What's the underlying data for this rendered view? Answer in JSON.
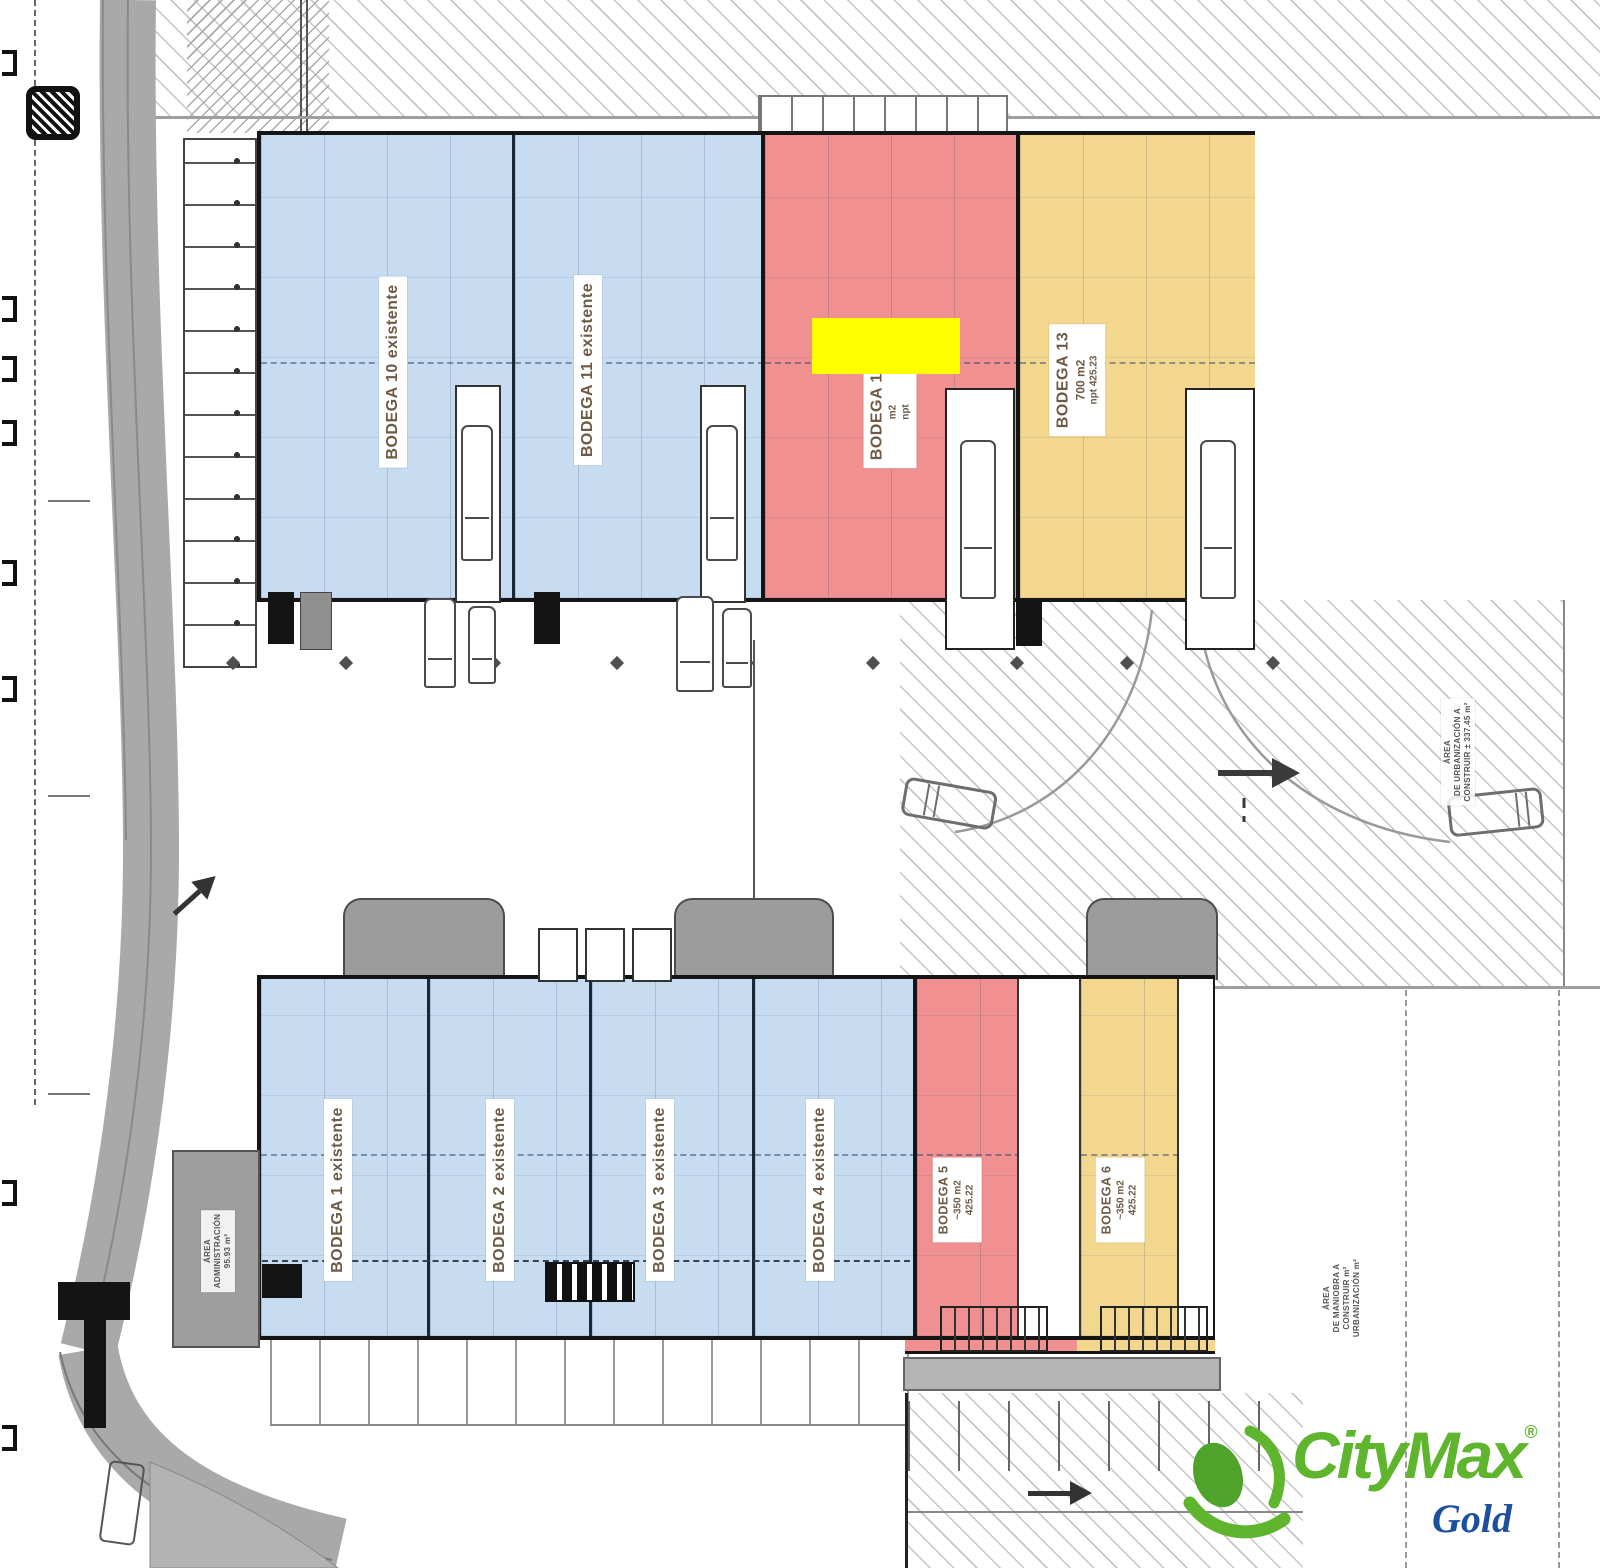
{
  "warehouses": {
    "top_row": [
      {
        "id": "bodega-10",
        "label": "BODEGA 10 existente",
        "fill": "#c7dbf1",
        "status": "existente"
      },
      {
        "id": "bodega-11",
        "label": "BODEGA 11 existente",
        "fill": "#c7dbf1",
        "status": "existente"
      },
      {
        "id": "bodega-12",
        "label": "BODEGA 12",
        "area": "m2",
        "level": "npt",
        "fill": "#f09090",
        "status": "disponible",
        "highlighted": true
      },
      {
        "id": "bodega-13",
        "label": "BODEGA 13",
        "area": "700 m2",
        "level": "npt 425.23",
        "fill": "#f3d78e",
        "status": "disponible"
      }
    ],
    "bottom_row": [
      {
        "id": "bodega-1",
        "label": "BODEGA 1 existente",
        "fill": "#c7dbf1",
        "status": "existente"
      },
      {
        "id": "bodega-2",
        "label": "BODEGA 2 existente",
        "fill": "#c7dbf1",
        "status": "existente"
      },
      {
        "id": "bodega-3",
        "label": "BODEGA 3 existente",
        "fill": "#c7dbf1",
        "status": "existente"
      },
      {
        "id": "bodega-4",
        "label": "BODEGA 4 existente",
        "fill": "#c7dbf1",
        "status": "existente"
      },
      {
        "id": "bodega-5",
        "label": "BODEGA 5",
        "area": "~350 m2",
        "level": "425.22",
        "fill": "#f09090",
        "status": "disponible"
      },
      {
        "id": "bodega-6",
        "label": "BODEGA 6",
        "area": "~350 m2",
        "level": "425.22",
        "fill": "#f3d78e",
        "status": "disponible"
      }
    ]
  },
  "annotations": {
    "administration": {
      "line1": "ÁREA",
      "line2": "ADMINISTRACIÓN",
      "line3": "95.93 m²"
    },
    "urbanization": {
      "line1": "ÁREA",
      "line2": "DE URBANIZACIÓN A",
      "line3": "CONSTRUIR ± 337.45 m²"
    },
    "maneuver": {
      "line1": "ÁREA",
      "line2": "DE MANIOBRA A",
      "line3": "CONSTRUIR m²",
      "line4": "URBANIZACIÓN m²"
    }
  },
  "branding": {
    "name": "CityMax",
    "registered": "®",
    "tier": "Gold",
    "brand_green": "#5fb52e",
    "tier_blue": "#1c4f9f"
  },
  "highlight": {
    "color": "#ffff00"
  },
  "colors": {
    "existing_unit_blue": "#c7dbf1",
    "available_red": "#f09090",
    "available_yellow": "#f3d78e",
    "outline": "#151515",
    "hatch": "#c6c6c6",
    "road": "#a9a9a9"
  }
}
